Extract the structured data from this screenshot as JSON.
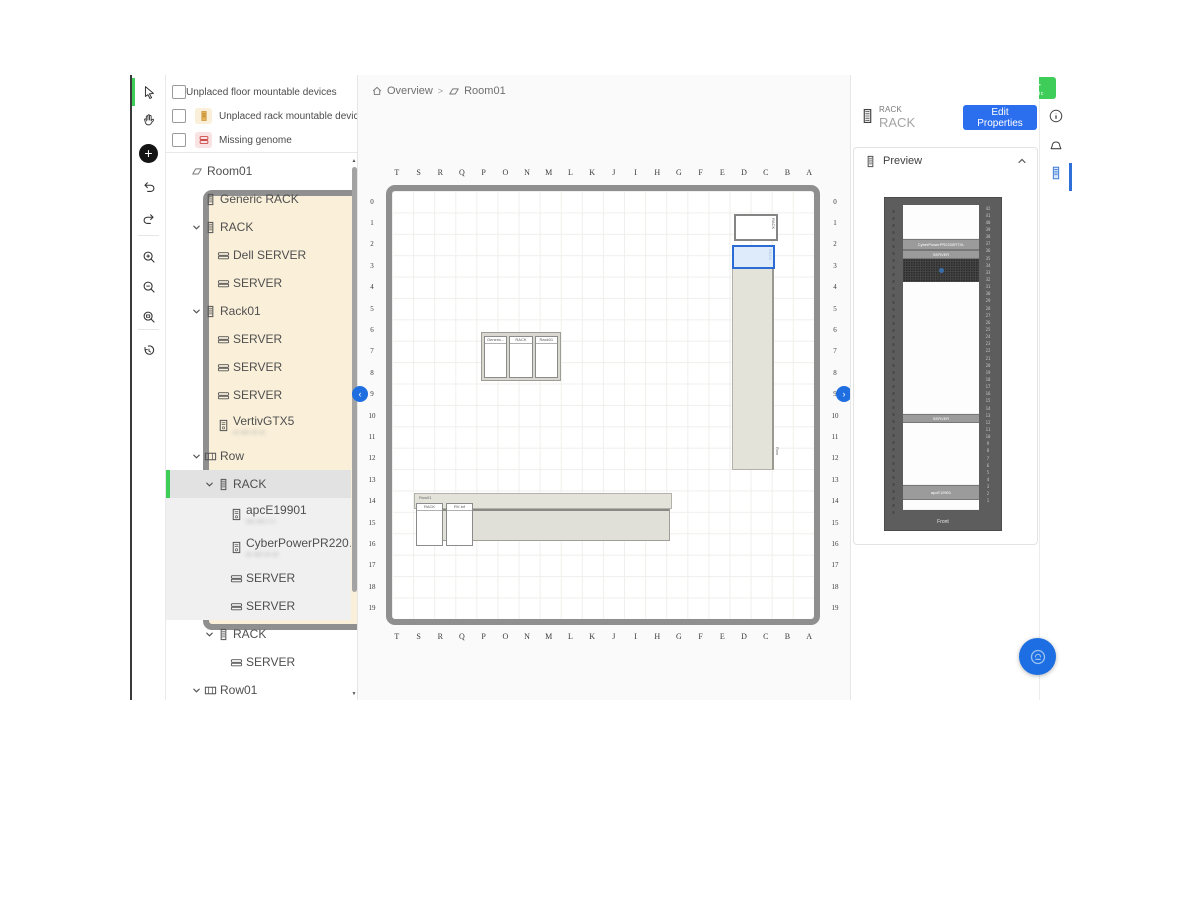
{
  "brand": {
    "logo_line1": "Schneider",
    "logo_line2": "Electric",
    "green": "#3dcd58"
  },
  "topbar": {
    "notification_count": "2",
    "icons": [
      "search",
      "help",
      "notifications",
      "feedback",
      "settings"
    ]
  },
  "right_strip": {
    "icons": [
      "info",
      "alarm",
      "rack-panel"
    ]
  },
  "breadcrumb": {
    "separator": ">",
    "items": [
      {
        "icon": "home-icon",
        "label": "Overview"
      },
      {
        "icon": "room-icon",
        "label": "Room01"
      }
    ]
  },
  "toolbar": {
    "tools": [
      {
        "name": "select",
        "selected": true
      },
      {
        "name": "pan"
      },
      {
        "name": "add"
      },
      {
        "name": "undo"
      },
      {
        "name": "redo"
      },
      {
        "name": "zoom-in"
      },
      {
        "name": "zoom-out"
      },
      {
        "name": "zoom-fit"
      },
      {
        "name": "history"
      }
    ]
  },
  "filters": [
    {
      "id": "unplaced-floor-devices",
      "chip": "floor",
      "label": "Unplaced floor mountable devices",
      "checked": false
    },
    {
      "id": "unplaced-rack-devices",
      "chip": "rack",
      "label": "Unplaced rack mountable devices",
      "checked": false
    },
    {
      "id": "missing-genome",
      "chip": "genome",
      "label": "Missing genome",
      "checked": false
    }
  ],
  "tree": {
    "items": [
      {
        "label": "Room01",
        "level": 0,
        "icon": "room"
      },
      {
        "label": "Generic RACK",
        "level": 1,
        "icon": "rack"
      },
      {
        "label": "RACK",
        "level": 1,
        "icon": "rack",
        "expanded": true
      },
      {
        "label": "Dell SERVER",
        "level": 2,
        "icon": "server"
      },
      {
        "label": "SERVER",
        "level": 2,
        "icon": "server"
      },
      {
        "label": "Rack01",
        "level": 1,
        "icon": "rack",
        "expanded": true
      },
      {
        "label": "SERVER",
        "level": 2,
        "icon": "server"
      },
      {
        "label": "SERVER",
        "level": 2,
        "icon": "server"
      },
      {
        "label": "SERVER",
        "level": 2,
        "icon": "server"
      },
      {
        "label": "VertivGTX5",
        "level": 2,
        "icon": "ups",
        "sub": "•• ••• •• ••",
        "sub_blurred": true
      },
      {
        "label": "Row",
        "level": 1,
        "icon": "row",
        "expanded": true
      },
      {
        "label": "RACK",
        "level": 2,
        "icon": "rack",
        "expanded": true,
        "selected": true
      },
      {
        "label": "apcE19901",
        "level": 3,
        "icon": "ups",
        "sub": "••• ••• • •",
        "sub_blurred": true,
        "highlighted": true
      },
      {
        "label": "CyberPowerPR2200R...",
        "level": 3,
        "icon": "ups",
        "sub": "•• ••• •• ••",
        "sub_blurred": true,
        "highlighted": true
      },
      {
        "label": "SERVER",
        "level": 3,
        "icon": "server",
        "highlighted": true
      },
      {
        "label": "SERVER",
        "level": 3,
        "icon": "server",
        "highlighted": true
      },
      {
        "label": "RACK",
        "level": 2,
        "icon": "rack",
        "expanded": true
      },
      {
        "label": "SERVER",
        "level": 3,
        "icon": "server"
      },
      {
        "label": "Row01",
        "level": 1,
        "icon": "row",
        "expanded": true
      }
    ]
  },
  "canvas": {
    "columns": [
      "T",
      "S",
      "R",
      "Q",
      "P",
      "O",
      "N",
      "M",
      "L",
      "K",
      "J",
      "I",
      "H",
      "G",
      "F",
      "E",
      "D",
      "C",
      "B",
      "A"
    ],
    "rows": [
      "0",
      "1",
      "2",
      "3",
      "4",
      "5",
      "6",
      "7",
      "8",
      "9",
      "10",
      "11",
      "12",
      "13",
      "14",
      "15",
      "16",
      "17",
      "18",
      "19"
    ],
    "nav_left": "‹",
    "nav_right": "›",
    "objects": {
      "rack_top": {
        "label": "RACK"
      },
      "rack_selected": {
        "label": "RACK"
      },
      "row_vertical": {
        "label": "Row"
      },
      "rack_group": {
        "racks": [
          "Generic...",
          "RACK",
          "Rack01"
        ]
      },
      "row_horizontal": {
        "label": "Row01",
        "racks": [
          "RACK",
          "RV-Inf"
        ]
      }
    }
  },
  "inspector": {
    "type_caption": "RACK",
    "title": "RACK",
    "edit_button": "Edit Properties",
    "preview": {
      "title": "Preview",
      "front_label": "Front",
      "unit_count": 42,
      "devices": [
        {
          "type": "gap",
          "h": 33
        },
        {
          "type": "bar",
          "label": "CyberPowerPR2200RTXL",
          "h": 9
        },
        {
          "type": "bar",
          "label": "SERVER",
          "h": 7
        },
        {
          "type": "vent",
          "h": 23
        },
        {
          "type": "gap",
          "h": 131
        },
        {
          "type": "bar",
          "label": "SERVER",
          "h": 7
        },
        {
          "type": "gap",
          "h": 61
        },
        {
          "type": "bar",
          "label": "apcE19901",
          "h": 13
        },
        {
          "type": "gap",
          "h": 9
        }
      ]
    }
  }
}
